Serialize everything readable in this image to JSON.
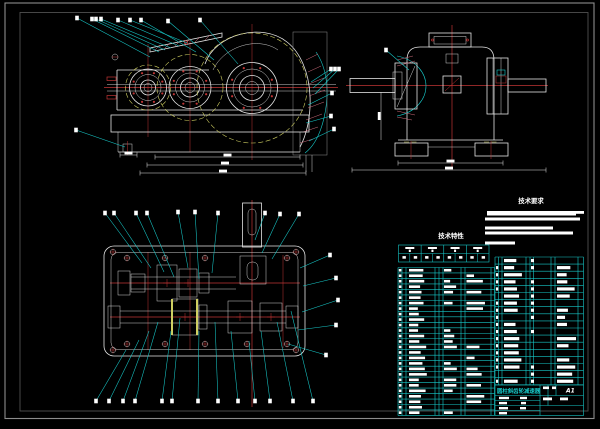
{
  "palette": {
    "bg": "#000000",
    "line": "#e4e4e4",
    "cyan": "#17c9c9",
    "red": "#c03434",
    "yellow": "#cfcf62",
    "dim": "#8f8f8f",
    "pink": "#cf6d7e",
    "text": "#ffffff",
    "frame_outer": "#8c8c8c",
    "frame_inner": "#4f4f4f",
    "hatch": "#a8a8a8"
  },
  "headings": {
    "tech_requirements": "技术要求",
    "tech_characteristics": "技术特性"
  },
  "title_block": {
    "title": "圆柱斜齿轮减速器",
    "sheet": "A1"
  },
  "tech_requirement_bars": [
    [
      487,
      211,
      89,
      4.5
    ],
    [
      576,
      211,
      8,
      2.8
    ],
    [
      485,
      217.5,
      95,
      3
    ],
    [
      485,
      226.5,
      68,
      3
    ],
    [
      485,
      231.5,
      88,
      3
    ],
    [
      485,
      241.5,
      30,
      3
    ]
  ],
  "tech_table": {
    "x": 398.5,
    "y": 245,
    "w": 90.5,
    "h": 17,
    "cols": 4,
    "mid": 8.5
  },
  "tables": [
    {
      "group": "bom-left",
      "x": 398,
      "y": 267.5,
      "rows": 27,
      "row_h": 5.48,
      "block_h": 2.6,
      "cols": [
        0,
        4,
        8,
        37,
        41,
        45,
        63,
        67,
        93,
        96.5
      ],
      "block_cols": [
        {
          "x": 0.8,
          "w": 2.6,
          "p": 0.92
        },
        {
          "x": 11,
          "wmin": 8,
          "wmax": 18,
          "p": 0.95
        },
        {
          "x": 46,
          "wmin": 6,
          "wmax": 13,
          "p": 0.55
        },
        {
          "x": 68.5,
          "wmin": 7,
          "wmax": 19,
          "p": 0.5
        }
      ],
      "seed": 7
    },
    {
      "group": "bom-right",
      "x": 495,
      "y": 257,
      "rows": 18,
      "row_h": 7.1,
      "block_h": 3.2,
      "cols": [
        0,
        3.5,
        7,
        31,
        35,
        38.5,
        56,
        60,
        83,
        88.5
      ],
      "block_cols": [
        {
          "x": 1,
          "w": 2.2,
          "p": 0.9
        },
        {
          "x": 9,
          "wmin": 10,
          "wmax": 18,
          "p": 0.95
        },
        {
          "x": 36,
          "w": 3,
          "p": 0.7
        },
        {
          "x": 62,
          "wmin": 8,
          "wmax": 20,
          "p": 0.55
        }
      ],
      "seed": 3
    }
  ],
  "title_marks": [
    [
      543,
      386.5,
      6,
      2.6
    ],
    [
      552,
      386.5,
      4,
      2.6
    ],
    [
      499,
      396.8,
      10,
      2.4
    ],
    [
      520,
      396.8,
      7,
      2.4
    ],
    [
      543,
      397.5,
      9,
      2.8
    ],
    [
      499,
      401.9,
      8,
      2.4
    ],
    [
      521,
      401.9,
      5,
      2.4
    ],
    [
      499,
      407,
      9,
      2.4
    ],
    [
      520,
      407,
      6,
      2.4
    ],
    [
      499,
      412,
      8,
      2.4
    ],
    [
      560,
      397.5,
      8,
      2.8
    ]
  ],
  "leader_sets": [
    {
      "group": "ov-view1",
      "labels": [
        [
          77,
          18,
          150,
          57
        ],
        [
          92,
          19,
          159,
          52
        ],
        [
          96,
          19,
          165,
          50
        ],
        [
          101,
          19,
          171,
          48
        ],
        [
          118,
          20,
          179,
          46
        ],
        [
          130,
          20,
          187,
          43
        ],
        [
          141,
          20,
          196,
          52
        ],
        [
          168,
          21,
          214,
          60
        ],
        [
          200,
          20,
          238,
          64
        ],
        [
          76,
          130,
          125,
          147
        ],
        [
          331,
          69,
          311,
          82
        ],
        [
          335,
          69,
          313,
          88
        ],
        [
          339,
          69,
          315,
          94
        ],
        [
          332,
          93,
          308,
          105
        ],
        [
          331,
          116,
          306,
          123
        ],
        [
          334,
          129,
          309,
          141
        ]
      ]
    },
    {
      "group": "ov-view3",
      "labels": [
        [
          386,
          50,
          409,
          70
        ]
      ]
    },
    {
      "group": "ov-view4",
      "labels": [
        [
          105,
          213,
          142,
          263
        ],
        [
          114,
          213,
          151,
          268
        ],
        [
          136,
          213,
          164,
          272
        ],
        [
          147,
          213,
          174,
          277
        ],
        [
          178,
          212,
          188,
          268
        ],
        [
          195,
          212,
          199,
          279
        ],
        [
          218,
          213,
          212,
          273
        ],
        [
          265,
          213,
          255,
          240
        ],
        [
          280,
          214,
          262,
          253
        ],
        [
          299,
          214,
          272,
          259
        ],
        [
          330,
          255,
          300,
          268
        ],
        [
          336,
          278,
          303,
          286
        ],
        [
          338,
          300,
          302,
          312
        ],
        [
          336,
          325,
          298,
          330
        ],
        [
          326,
          355,
          288,
          344
        ],
        [
          96,
          401,
          126,
          350
        ],
        [
          109,
          401,
          139,
          340
        ],
        [
          123,
          401,
          149,
          331
        ],
        [
          135,
          401,
          158,
          322
        ],
        [
          162,
          401,
          171,
          331
        ],
        [
          172,
          401,
          180,
          318
        ],
        [
          198,
          401,
          199,
          331
        ],
        [
          218,
          401,
          215,
          322
        ],
        [
          238,
          401,
          231,
          331
        ],
        [
          255,
          401,
          249,
          341
        ],
        [
          270,
          401,
          261,
          331
        ],
        [
          293,
          401,
          277,
          322
        ],
        [
          313,
          401,
          291,
          311
        ]
      ]
    }
  ],
  "dims": {
    "h": [
      [
        155,
        157,
        300,
        157
      ],
      [
        147,
        165,
        303,
        165
      ],
      [
        140,
        173,
        306,
        173
      ],
      [
        120,
        155,
        137,
        155
      ],
      [
        398,
        163,
        503,
        163
      ],
      [
        352,
        170,
        546,
        170
      ]
    ],
    "v": [
      [
        381,
        92,
        381,
        140
      ]
    ]
  },
  "bolt_rings": [
    {
      "cx": 148,
      "cy": 87.5,
      "r": 15.5,
      "n": 8
    },
    {
      "cx": 190,
      "cy": 87.5,
      "r": 17.5,
      "n": 8
    },
    {
      "cx": 252,
      "cy": 88,
      "r": 21.5,
      "n": 8
    }
  ],
  "bolts_plan": [
    [
      127,
      258
    ],
    [
      165,
      258
    ],
    [
      205,
      258
    ],
    [
      287,
      258
    ],
    [
      127,
      344
    ],
    [
      165,
      344
    ],
    [
      205,
      344
    ],
    [
      247,
      344
    ],
    [
      287,
      344
    ],
    [
      113,
      252
    ],
    [
      296,
      252
    ],
    [
      113,
      350
    ],
    [
      296,
      350
    ]
  ]
}
